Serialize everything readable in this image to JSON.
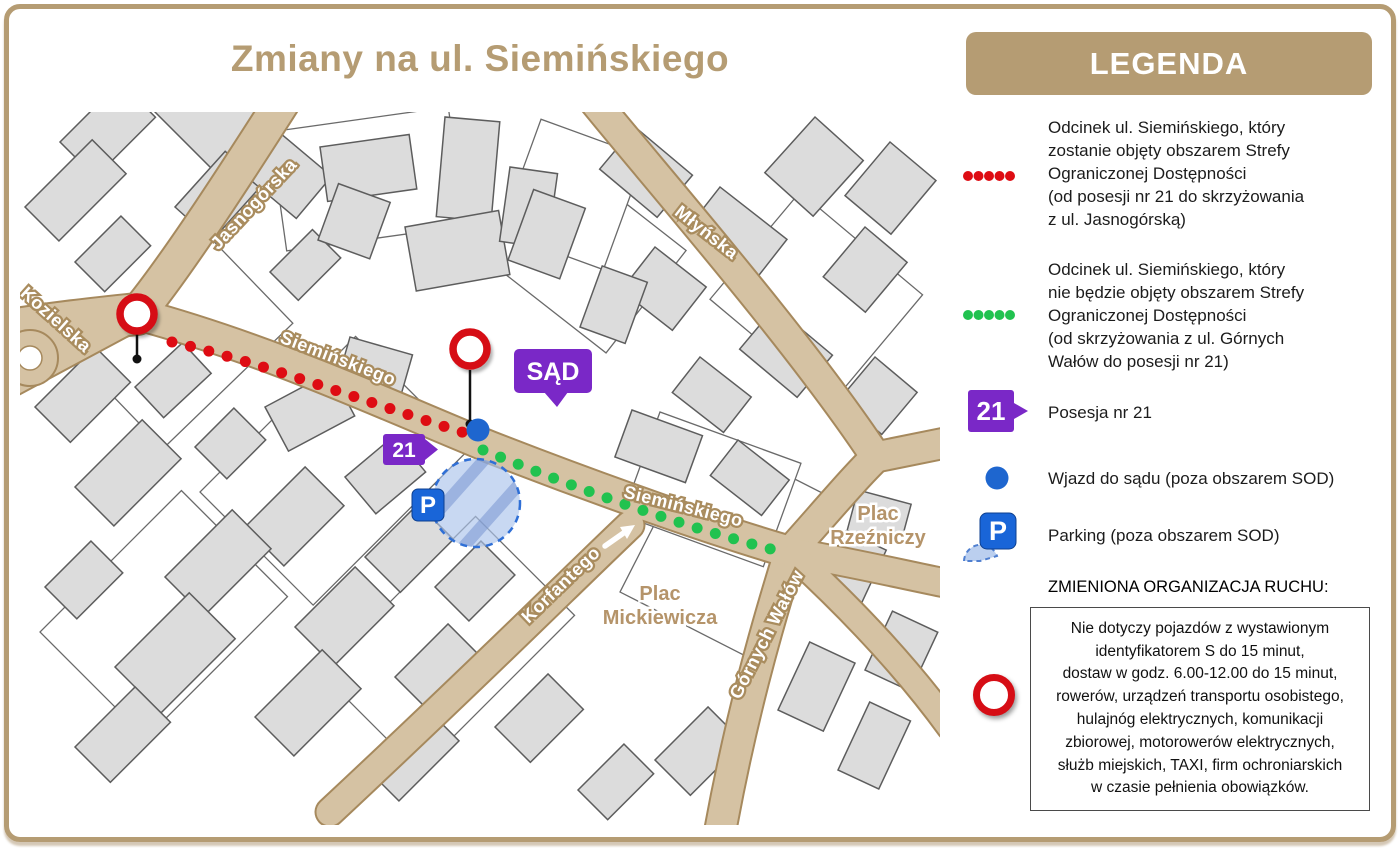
{
  "title": "Zmiany na ul. Siemińskiego",
  "map": {
    "streets": [
      {
        "name": "Jasnogórska"
      },
      {
        "name": "Kozielska"
      },
      {
        "name": "Siemińskiego"
      },
      {
        "name": "Młyńska"
      },
      {
        "name": "Siemińskiego"
      },
      {
        "name": "Korfantego"
      },
      {
        "name": "Górnych Wałów"
      }
    ],
    "places": [
      {
        "lines": [
          "Plac",
          "Mickiewicza"
        ]
      },
      {
        "lines": [
          "Plac",
          "Rzeźniczy"
        ]
      }
    ],
    "markers": {
      "court_badge": "SĄD",
      "property_badge": "21",
      "parking_badge": "P"
    }
  },
  "legend": {
    "header": "LEGENDA",
    "items": [
      {
        "icon": "red-dotted-line",
        "text": "Odcinek ul. Siemińskiego, który\nzostanie objęty obszarem Strefy\nOgraniczonej Dostępności\n(od posesji nr 21 do skrzyżowania\nz ul. Jasnogórską)"
      },
      {
        "icon": "green-dotted-line",
        "text": "Odcinek ul. Siemińskiego, który\nnie będzie objęty obszarem Strefy\nOgraniczonej Dostępności\n(od skrzyżowania z ul. Górnych\nWałów do posesji nr 21)"
      },
      {
        "icon": "property-21-badge",
        "badge_label": "21",
        "text": "Posesja nr 21"
      },
      {
        "icon": "blue-dot",
        "text": "Wjazd do sądu (poza obszarem SOD)"
      },
      {
        "icon": "parking",
        "badge_label": "P",
        "text": "Parking (poza obszarem SOD)"
      }
    ],
    "traffic_header": "ZMIENIONA ORGANIZACJA RUCHU:",
    "traffic_note": "Nie dotyczy pojazdów z wystawionym\nidentyfikatorem S do 15 minut,\ndostaw w godz. 6.00-12.00 do 15 minut,\nrowerów, urządzeń transportu osobistego,\nhulajnóg elektrycznych, komunikacji\nzbiorowej, motorowerów elektrycznych,\nsłużb miejskich, TAXI, firm ochroniarskich\nw czasie pełnienia obowiązków."
  },
  "colors": {
    "accent_tan": "#b59c73",
    "road_fill": "#d5c2a3",
    "restricted_red": "#de0c13",
    "open_green": "#21c24f",
    "badge_purple": "#7a28c7",
    "parking_blue": "#1965d8"
  }
}
